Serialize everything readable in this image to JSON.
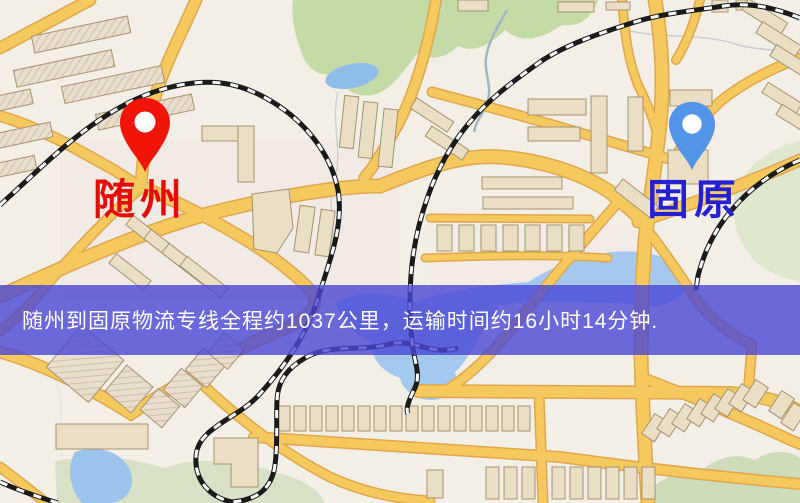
{
  "map": {
    "origin": {
      "label": "随州",
      "label_color": "#e50b06",
      "pin_color": "#f31408"
    },
    "destination": {
      "label": "固原",
      "label_color": "#2521d3",
      "pin_color": "#5294e8"
    },
    "palette": {
      "background": "#f4efe6",
      "road_fill": "#f6c95e",
      "road_casing": "#dfa74d",
      "water": "#9cc4ec",
      "park_green": "#c5dba6",
      "pale_green": "#d8e0c6",
      "building": "#eadfc5",
      "railway": "#1a1a1a"
    }
  },
  "banner": {
    "text": "随州到固原物流专线全程约1037公里，运输时间约16小时14分钟.",
    "text_color": "#ffffff",
    "overlay_rgba": "rgba(72,70,214,0.8)"
  }
}
